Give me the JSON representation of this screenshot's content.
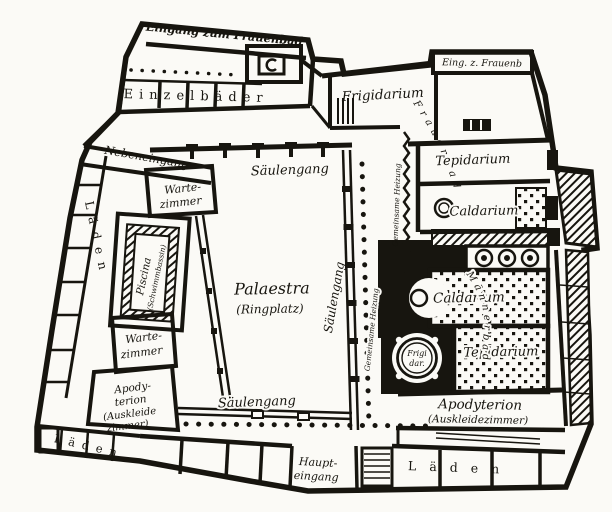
{
  "plan": {
    "ink_color": "#17150f",
    "paper_color": "#fbfaf6",
    "labels": {
      "eingang_zum_frauenbad": "Eingang zum Frauenbad",
      "einzelbaeder": "Einzelbäder",
      "eing_z_frauenb": "Eing. z. Frauenb",
      "frigidarium": "Frigidarium",
      "frauenbad": "Frauenbad",
      "maennerbad": "Männerbad",
      "tepidarium": "Tepidarium",
      "caldarium": "Caldarium",
      "nebeneingang": "Nebeneingang",
      "wartezimmer": [
        "Warte-",
        "zimmer"
      ],
      "piscina": [
        "Piscina",
        "(Schwimmbassin)"
      ],
      "laeden": "Läden",
      "saeulengang": "Säulengang",
      "palaestra": [
        "Palaestra",
        "(Ringplatz)"
      ],
      "gemeinsame_heizung": "Gemeinsame Heizung",
      "apodyterion_frauen": [
        "Apody-",
        "terion",
        "(Auskleide",
        "zimmer)"
      ],
      "haupteingang": [
        "Haupt-",
        "eingang"
      ],
      "apodyterion_maenner": [
        "Apodyterion",
        "(Auskleidezimmer)"
      ],
      "frigidar": [
        "Frigi",
        "dar."
      ]
    }
  }
}
